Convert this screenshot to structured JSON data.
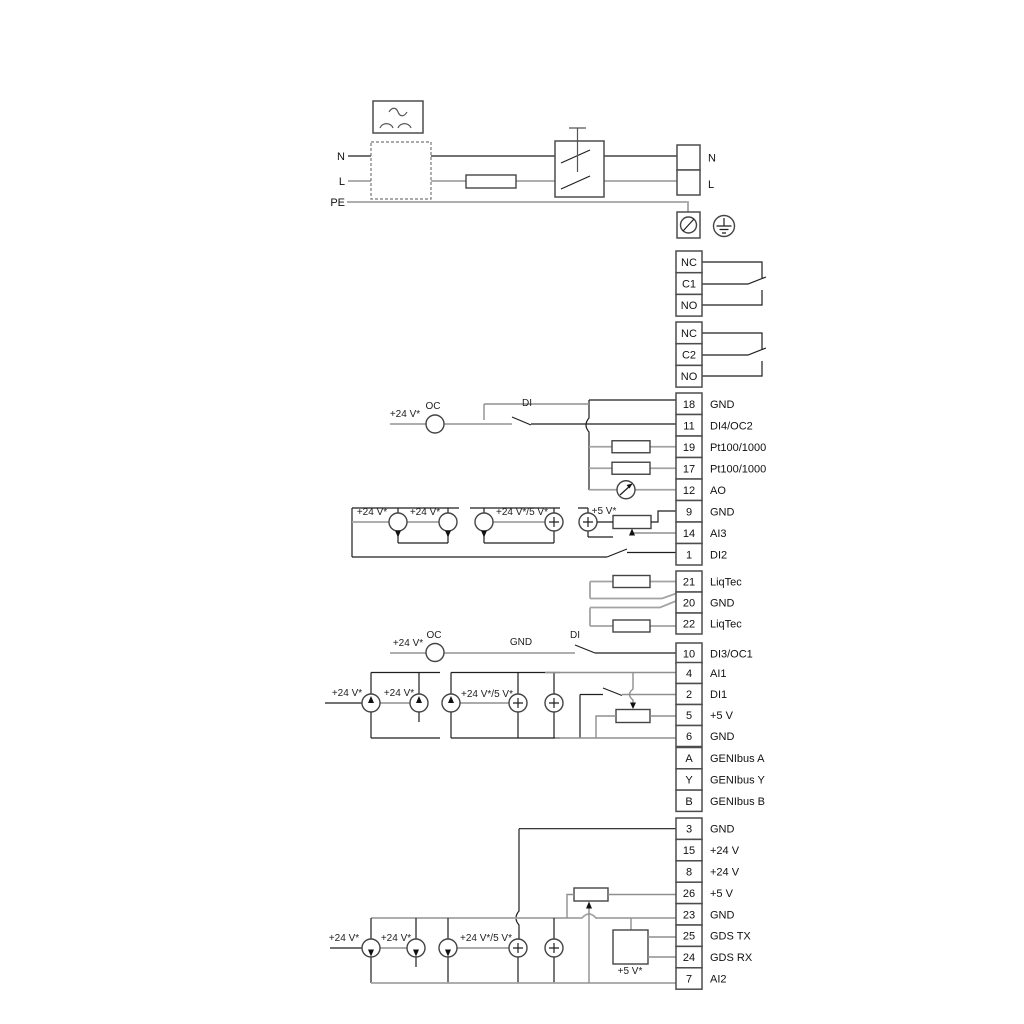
{
  "power_labels": {
    "n_left": "N",
    "l_left": "L",
    "pe": "PE",
    "n_right": "N",
    "l_right": "L"
  },
  "terminals": {
    "relay1": [
      "NC",
      "C1",
      "NO"
    ],
    "relay2": [
      "NC",
      "C2",
      "NO"
    ],
    "io_groups": [
      {
        "rows": [
          [
            "18",
            "GND"
          ],
          [
            "11",
            "DI4/OC2"
          ],
          [
            "19",
            "Pt100/1000"
          ],
          [
            "17",
            "Pt100/1000"
          ],
          [
            "12",
            "AO"
          ],
          [
            "9",
            "GND"
          ],
          [
            "14",
            "AI3"
          ],
          [
            "1",
            "DI2"
          ]
        ]
      },
      {
        "rows": [
          [
            "21",
            "LiqTec"
          ],
          [
            "20",
            "GND"
          ],
          [
            "22",
            "LiqTec"
          ]
        ]
      },
      {
        "rows": [
          [
            "10",
            "DI3/OC1"
          ]
        ]
      },
      {
        "rows": [
          [
            "4",
            "AI1"
          ],
          [
            "2",
            "DI1"
          ],
          [
            "5",
            "+5 V"
          ],
          [
            "6",
            "GND"
          ]
        ]
      },
      {
        "rows": [
          [
            "A",
            "GENIbus A"
          ],
          [
            "Y",
            "GENIbus Y"
          ],
          [
            "B",
            "GENIbus B"
          ]
        ]
      },
      {
        "rows": [
          [
            "3",
            "GND"
          ],
          [
            "15",
            "+24 V"
          ],
          [
            "8",
            "+24 V"
          ],
          [
            "26",
            "+5 V"
          ],
          [
            "23",
            "GND"
          ],
          [
            "25",
            "GDS TX"
          ],
          [
            "24",
            "GDS RX"
          ],
          [
            "7",
            "AI2"
          ]
        ]
      }
    ]
  },
  "labels": {
    "v24": "+24 V*",
    "v24_5": "+24 V*/5 V*",
    "v5": "+5 V*",
    "oc": "OC",
    "di": "DI",
    "gnd": "GND"
  },
  "colors": {
    "wire_dark": "#1f1f1f",
    "wire_gray": "#a3a3a3",
    "component_stroke": "#444444",
    "text": "#111111"
  }
}
